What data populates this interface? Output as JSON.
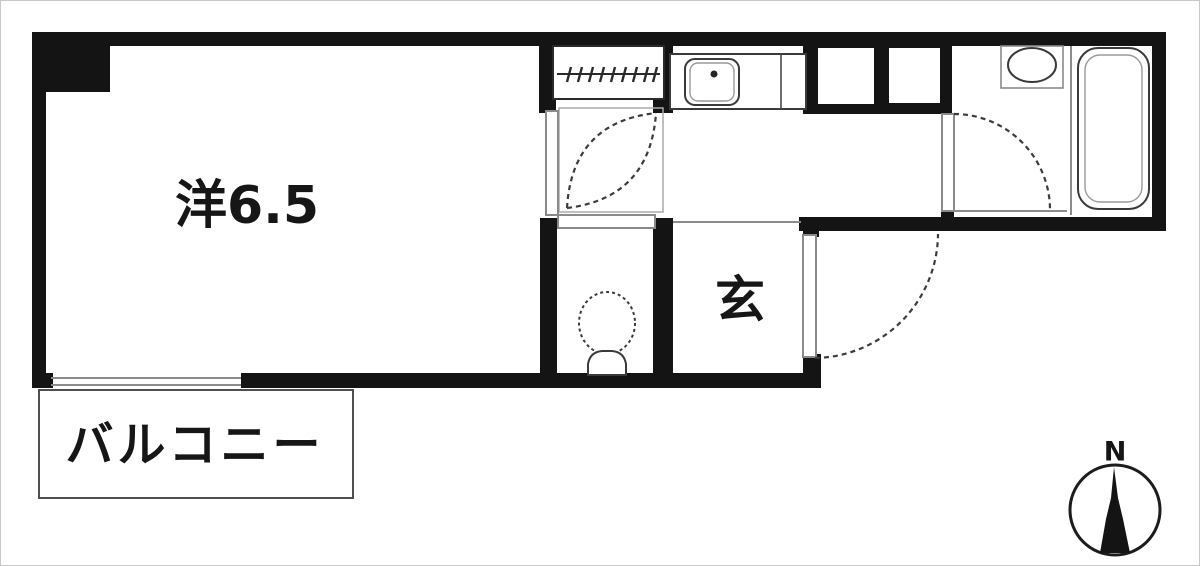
{
  "labels": {
    "main_room": "洋6.5",
    "entrance": "玄",
    "balcony": "バルコニー",
    "compass_north": "N"
  },
  "colors": {
    "wall": "#141414",
    "thin_line": "#8c8c8c",
    "door_arc": "#3c3c3c",
    "fixture_line": "#3a3a3a",
    "background": "#ffffff"
  },
  "icons": {
    "compass_needle": "north-needle-icon",
    "louver_window": "louver-window-icon",
    "balcony_window": "balcony-window-icon",
    "room_door": "room-door-swing-icon",
    "toilet_door": "toilet-door-icon",
    "entrance_door": "entrance-door-swing-icon",
    "bathroom_door": "bathroom-door-swing-icon",
    "kitchen_sink": "kitchen-sink-icon",
    "wash_basin": "wash-basin-icon",
    "bathtub": "bathtub-icon",
    "toilet": "toilet-icon"
  }
}
